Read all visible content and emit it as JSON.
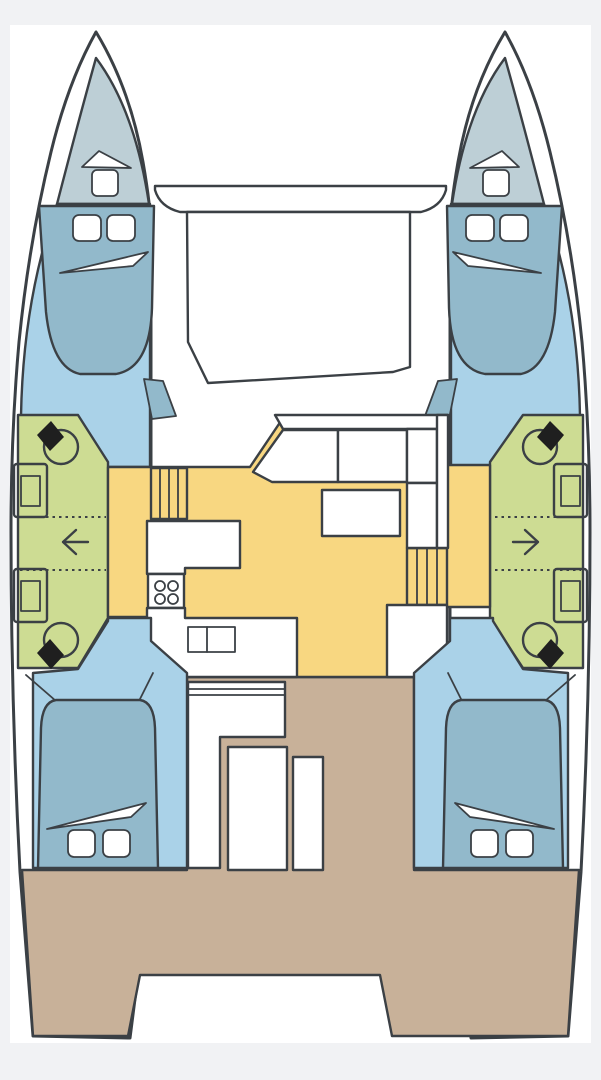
{
  "diagram": {
    "type": "catamaran-floorplan",
    "orientation": "bow-up",
    "hull_count": 2
  },
  "colors": {
    "background": "#f1f2f4",
    "canvas": "#ffffff",
    "outline": "#3b4045",
    "white": "#ffffff",
    "forepeak": "#bdcfd6",
    "cabin_floor": "#aad2e8",
    "berth": "#92b9cb",
    "head_compartment": "#cddc93",
    "saloon": "#f8d781",
    "cockpit": "#c8b199",
    "fixture_black": "#1f1f1f"
  },
  "regions": {
    "port_forepeak": "forepeak-locker",
    "starboard_forepeak": "forepeak-locker",
    "port_forward_cabin": "forward-berth",
    "starboard_forward_cabin": "forward-berth",
    "port_head": "head-with-wc",
    "starboard_head": "head-with-wc",
    "saloon": "saloon-galley-settee",
    "cockpit": "aft-cockpit",
    "port_aft_cabin": "aft-berth",
    "starboard_aft_cabin": "aft-berth",
    "foredeck": "trampoline"
  },
  "icons": {
    "port_walkthrough": "arrow-left",
    "starboard_walkthrough": "arrow-right"
  }
}
